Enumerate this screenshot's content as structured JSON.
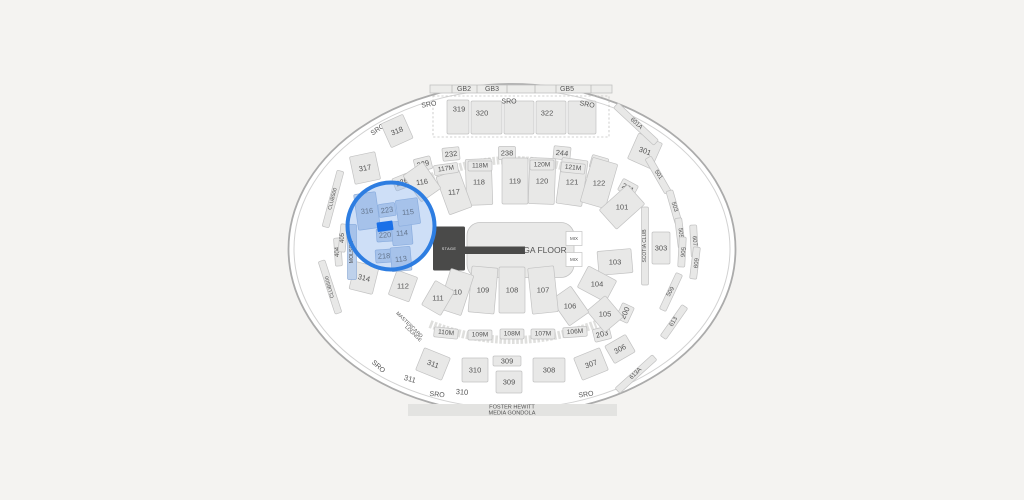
{
  "map": {
    "colors": {
      "background": "#f4f3f1",
      "arena_fill": "#ffffff",
      "ring": "#ababab",
      "ring_inner": "#d2d2d2",
      "section_fill": "#e8e8e7",
      "section_stroke": "#c2c2c2",
      "label": "#545454",
      "highlight_fill": "#bed1eb",
      "highlight_stroke": "#93afd7",
      "selection_circle": "#2d7de1",
      "selection_circle_fill": "rgba(126,172,235,0.38)",
      "selected_block": "#1a70e8",
      "stage_fill": "#4a4a49",
      "floor_fill": "#e9e9e8",
      "gondola_fill": "#e3e3e1"
    },
    "stage_label": "STAGE",
    "floor_label": "GA FLOOR",
    "mix_label": "MIX",
    "gb_labels": [
      "GB2",
      "GB3",
      "GB5"
    ],
    "gondola": {
      "line1": "FOSTER HEWITT",
      "line2": "MEDIA GONDOLA"
    },
    "sections": [
      {
        "t": "SRO",
        "x": 429,
        "y": 105,
        "r": -10,
        "k": "sro"
      },
      {
        "t": "SRO",
        "x": 509,
        "y": 102,
        "r": 0,
        "k": "sro"
      },
      {
        "t": "SRO",
        "x": 587,
        "y": 105,
        "r": 10,
        "k": "sro"
      },
      {
        "t": "SRO",
        "x": 378,
        "y": 130,
        "r": -35,
        "k": "sro"
      },
      {
        "t": "SRO",
        "x": 378,
        "y": 367,
        "r": 42,
        "k": "sro"
      },
      {
        "t": "SRO",
        "x": 437,
        "y": 395,
        "r": 6,
        "k": "sro"
      },
      {
        "t": "SRO",
        "x": 586,
        "y": 395,
        "r": -8,
        "k": "sro"
      },
      {
        "t": "319",
        "x": 459,
        "y": 109,
        "r": 0,
        "k": "plain"
      },
      {
        "t": "320",
        "x": 482,
        "y": 113,
        "r": 0,
        "k": "plain"
      },
      {
        "t": "322",
        "x": 547,
        "y": 113,
        "r": 0,
        "k": "plain"
      },
      {
        "t": "318",
        "x": 397,
        "y": 131,
        "r": -22,
        "k": "sec300",
        "br": -24,
        "w": 24,
        "h": 26
      },
      {
        "t": "317",
        "x": 365,
        "y": 168,
        "r": -10,
        "k": "sec300",
        "br": -12,
        "w": 26,
        "h": 28
      },
      {
        "t": "316",
        "x": 367,
        "y": 211,
        "r": -5,
        "k": "sec300",
        "hl": true,
        "w": 22,
        "h": 36,
        "br": -8
      },
      {
        "t": "314",
        "x": 364,
        "y": 278,
        "r": 14,
        "k": "sec300",
        "br": 14,
        "w": 24,
        "h": 28
      },
      {
        "t": "311",
        "x": 433,
        "y": 364,
        "r": 20,
        "k": "sec300",
        "br": 22,
        "w": 28,
        "h": 24
      },
      {
        "t": "311",
        "x": 410,
        "y": 379,
        "r": 16,
        "k": "plain"
      },
      {
        "t": "310",
        "x": 475,
        "y": 370,
        "r": 0,
        "k": "sec300",
        "w": 26,
        "h": 24
      },
      {
        "t": "310",
        "x": 462,
        "y": 392,
        "r": 4,
        "k": "plain"
      },
      {
        "t": "309",
        "x": 507,
        "y": 361,
        "r": 0,
        "k": "sec300s",
        "w": 28,
        "h": 10
      },
      {
        "t": "309",
        "x": 509,
        "y": 382,
        "r": 0,
        "k": "sec300s",
        "w": 26,
        "h": 22
      },
      {
        "t": "308",
        "x": 549,
        "y": 370,
        "r": 0,
        "k": "sec300",
        "w": 32,
        "h": 24
      },
      {
        "t": "307",
        "x": 591,
        "y": 364,
        "r": -20,
        "k": "sec300",
        "br": -22,
        "w": 28,
        "h": 24
      },
      {
        "t": "306",
        "x": 620,
        "y": 349,
        "r": -28,
        "k": "sec300s",
        "br": -30
      },
      {
        "t": "301",
        "x": 645,
        "y": 151,
        "r": 20,
        "k": "sec300",
        "br": 24,
        "w": 26,
        "h": 28
      },
      {
        "t": "303",
        "x": 661,
        "y": 248,
        "r": 0,
        "k": "sec300s",
        "w": 18,
        "h": 32
      },
      {
        "t": "229",
        "x": 423,
        "y": 164,
        "r": -14,
        "k": "sec200"
      },
      {
        "t": "232",
        "x": 451,
        "y": 154,
        "r": -6,
        "k": "sec200"
      },
      {
        "t": "238",
        "x": 507,
        "y": 153,
        "r": 0,
        "k": "sec200"
      },
      {
        "t": "244",
        "x": 562,
        "y": 153,
        "r": 6,
        "k": "sec200"
      },
      {
        "t": "248",
        "x": 599,
        "y": 163,
        "r": 16,
        "k": "sec200"
      },
      {
        "t": "251",
        "x": 628,
        "y": 188,
        "r": 28,
        "k": "sec200"
      },
      {
        "t": "226",
        "x": 402,
        "y": 182,
        "r": -22,
        "k": "sec200"
      },
      {
        "t": "223",
        "x": 387,
        "y": 210,
        "r": -8,
        "k": "sec200",
        "hl": true
      },
      {
        "t": "220",
        "x": 385,
        "y": 235,
        "r": -4,
        "k": "sec200",
        "hl": true
      },
      {
        "t": "218",
        "x": 384,
        "y": 256,
        "r": -4,
        "k": "sec200",
        "hl": true
      },
      {
        "t": "203",
        "x": 602,
        "y": 334,
        "r": -14,
        "k": "sec200"
      },
      {
        "t": "200",
        "x": 625,
        "y": 313,
        "r": -65,
        "k": "sec200",
        "br": -65
      },
      {
        "t": "118",
        "x": 479,
        "y": 182,
        "r": 0,
        "k": "sec100",
        "br": -2
      },
      {
        "t": "119",
        "x": 515,
        "y": 181,
        "r": 0,
        "k": "sec100"
      },
      {
        "t": "120",
        "x": 542,
        "y": 181,
        "r": 0,
        "k": "sec100",
        "br": 2
      },
      {
        "t": "121",
        "x": 572,
        "y": 182,
        "r": 0,
        "k": "sec100",
        "br": 8
      },
      {
        "t": "122",
        "x": 599,
        "y": 183,
        "r": 0,
        "k": "sec100",
        "br": 16
      },
      {
        "t": "117",
        "x": 454,
        "y": 192,
        "r": -5,
        "k": "sec100",
        "br": -20,
        "w": 24,
        "h": 40
      },
      {
        "t": "116",
        "x": 422,
        "y": 182,
        "r": -8,
        "k": "sec100",
        "br": -35,
        "w": 24,
        "h": 32
      },
      {
        "t": "101",
        "x": 622,
        "y": 207,
        "r": 0,
        "k": "sec100",
        "br": 48,
        "w": 26,
        "h": 38
      },
      {
        "t": "103",
        "x": 615,
        "y": 262,
        "r": 0,
        "k": "sec100",
        "br": 85,
        "w": 24,
        "h": 34
      },
      {
        "t": "104",
        "x": 597,
        "y": 284,
        "r": 0,
        "k": "sec100",
        "br": 118,
        "w": 24,
        "h": 32
      },
      {
        "t": "105",
        "x": 605,
        "y": 314,
        "r": 0,
        "k": "sec100",
        "br": -40,
        "w": 24,
        "h": 28
      },
      {
        "t": "106",
        "x": 570,
        "y": 306,
        "r": 0,
        "k": "sec100",
        "br": -35,
        "w": 24,
        "h": 32
      },
      {
        "t": "107",
        "x": 543,
        "y": 290,
        "r": 0,
        "k": "sec100",
        "br": -6,
        "h": 46
      },
      {
        "t": "108",
        "x": 512,
        "y": 290,
        "r": 0,
        "k": "sec100",
        "h": 46
      },
      {
        "t": "109",
        "x": 483,
        "y": 290,
        "r": 0,
        "k": "sec100",
        "br": 5,
        "h": 46
      },
      {
        "t": "110",
        "x": 456,
        "y": 292,
        "r": 0,
        "k": "sec100",
        "br": 18,
        "w": 24,
        "h": 42
      },
      {
        "t": "111",
        "x": 438,
        "y": 298,
        "r": 0,
        "k": "sec100",
        "br": 30,
        "w": 22,
        "h": 28
      },
      {
        "t": "112",
        "x": 403,
        "y": 286,
        "r": 0,
        "k": "sec100",
        "br": 20,
        "w": 22,
        "h": 26
      },
      {
        "t": "113",
        "x": 401,
        "y": 259,
        "r": -6,
        "k": "sec100",
        "hl": true,
        "w": 20,
        "h": 24,
        "br": -5
      },
      {
        "t": "114",
        "x": 402,
        "y": 233,
        "r": -5,
        "k": "sec100",
        "hl": true,
        "w": 20,
        "h": 24,
        "br": -5
      },
      {
        "t": "115",
        "x": 408,
        "y": 212,
        "r": -5,
        "k": "sec100",
        "hl": true,
        "w": 22,
        "h": 26,
        "br": -8
      },
      {
        "t": "117M",
        "x": 446,
        "y": 169,
        "r": -8,
        "k": "mlevel"
      },
      {
        "t": "118M",
        "x": 480,
        "y": 166,
        "r": 0,
        "k": "mlevel"
      },
      {
        "t": "120M",
        "x": 542,
        "y": 165,
        "r": 0,
        "k": "mlevel"
      },
      {
        "t": "121M",
        "x": 573,
        "y": 168,
        "r": 6,
        "k": "mlevel"
      },
      {
        "t": "110M",
        "x": 446,
        "y": 333,
        "r": 6,
        "k": "mlevel"
      },
      {
        "t": "109M",
        "x": 480,
        "y": 335,
        "r": 0,
        "k": "mlevel"
      },
      {
        "t": "108M",
        "x": 512,
        "y": 334,
        "r": 0,
        "k": "mlevel"
      },
      {
        "t": "107M",
        "x": 543,
        "y": 334,
        "r": 0,
        "k": "mlevel"
      },
      {
        "t": "106M",
        "x": 575,
        "y": 332,
        "r": -4,
        "k": "mlevel"
      },
      {
        "t": "CLUB500",
        "x": 333,
        "y": 199,
        "r": -75,
        "k": "strip",
        "br": 15,
        "h": 58,
        "fs": 5.2
      },
      {
        "t": "CLUB500",
        "x": 330,
        "y": 287,
        "r": -105,
        "k": "strip",
        "br": -18,
        "h": 55,
        "fs": 5.2
      },
      {
        "t": "404",
        "x": 338,
        "y": 252,
        "r": -90,
        "k": "strip",
        "br": -4,
        "h": 28,
        "fs": 6
      },
      {
        "t": "405",
        "x": 343,
        "y": 238,
        "r": -90,
        "k": "strip",
        "br": 6,
        "h": 28,
        "fs": 6
      },
      {
        "t": "MOLSON",
        "x": 352,
        "y": 252,
        "r": -90,
        "k": "strip",
        "br": 0,
        "h": 55,
        "w": 9,
        "hl": true,
        "fs": 5.2
      },
      {
        "t": "SCOTIA CLUB",
        "x": 645,
        "y": 246,
        "r": -90,
        "k": "strip",
        "br": 0,
        "h": 78,
        "fs": 5
      },
      {
        "t": "501",
        "x": 658,
        "y": 175,
        "r": 55,
        "k": "strip",
        "br": -30,
        "h": 40,
        "fs": 6
      },
      {
        "t": "503",
        "x": 674,
        "y": 207,
        "r": 72,
        "k": "strip",
        "br": -16,
        "h": 34,
        "fs": 6
      },
      {
        "t": "505",
        "x": 680,
        "y": 233,
        "r": 85,
        "k": "strip",
        "br": -7,
        "h": 30,
        "fs": 6
      },
      {
        "t": "506",
        "x": 682,
        "y": 252,
        "r": 95,
        "k": "strip",
        "br": 3,
        "h": 30,
        "fs": 6
      },
      {
        "t": "607",
        "x": 694,
        "y": 241,
        "r": 85,
        "k": "strip",
        "br": -3,
        "h": 32,
        "fs": 6
      },
      {
        "t": "609",
        "x": 695,
        "y": 263,
        "r": 95,
        "k": "strip",
        "br": 7,
        "h": 32,
        "fs": 6
      },
      {
        "t": "509",
        "x": 671,
        "y": 292,
        "r": -60,
        "k": "strip",
        "br": 25,
        "h": 40,
        "fs": 6
      },
      {
        "t": "613",
        "x": 674,
        "y": 322,
        "r": -60,
        "k": "strip",
        "br": 35,
        "h": 38,
        "fs": 6
      },
      {
        "t": "601A",
        "x": 636,
        "y": 124,
        "r": 42,
        "k": "strip",
        "br": -47,
        "h": 55,
        "fs": 6
      },
      {
        "t": "613A",
        "x": 636,
        "y": 374,
        "r": -45,
        "k": "strip",
        "br": 48,
        "h": 50,
        "fs": 6
      },
      {
        "t": "MASTERCARD",
        "x": 409,
        "y": 325,
        "r": 44,
        "k": "small"
      },
      {
        "t": "LOUNGE",
        "x": 413,
        "y": 334,
        "r": 44,
        "k": "small"
      }
    ],
    "selection": {
      "circle": {
        "cx": 391,
        "cy": 226,
        "r": 43.5
      },
      "selected_block": {
        "x": 377,
        "y": 221.5,
        "w": 16,
        "h": 9.5,
        "rotate": -8
      }
    }
  }
}
